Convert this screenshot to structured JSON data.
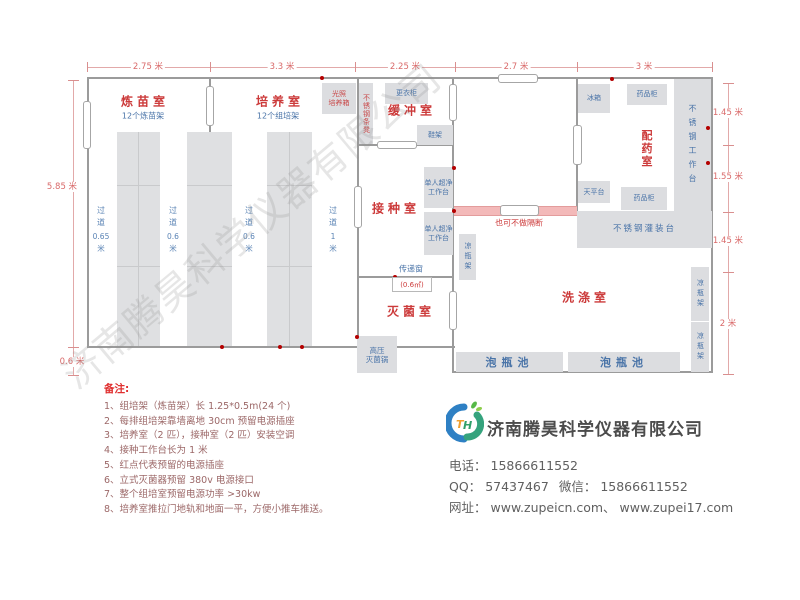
{
  "dims": {
    "top": [
      "2.75 米",
      "3.3 米",
      "2.25 米",
      "2.7 米",
      "3 米"
    ],
    "left_main": "5.85 米",
    "left_ext": "0.6 米",
    "right": [
      "1.45 米",
      "1.55 米",
      "1.45 米",
      "2 米"
    ]
  },
  "rooms": {
    "lianmiao": "炼苗室",
    "lianmiao_sub": "12个炼苗架",
    "peiyang": "培养室",
    "peiyang_sub": "12个组培架",
    "huanchong": "缓冲室",
    "jiezhong": "接种室",
    "miejun": "灭菌室",
    "xidi": "洗涤室",
    "peiyao": "配药室"
  },
  "furniture": {
    "light_incubator_1": "光照",
    "light_incubator_2": "培养箱",
    "steel_bench": "不锈钢条凳",
    "wardrobe": "更衣柜",
    "shoe_rack": "鞋架",
    "clean_bench_1": "单人超净",
    "clean_bench_2": "工作台",
    "cool_rack": "凉瓶架",
    "autoclave_1": "高压",
    "autoclave_2": "灭菌锅",
    "fridge": "冰箱",
    "med_cabinet_top": "药品柜",
    "med_cabinet_bottom": "药品柜",
    "steel_worktable": "不锈钢工作台",
    "balance_table": "天平台",
    "filling_table": "不锈钢灌装台",
    "soak_pool_1": "泡瓶池",
    "soak_pool_2": "泡瓶池",
    "cool_rack_r1": "凉瓶架",
    "cool_rack_r2": "凉瓶架"
  },
  "aisles": [
    {
      "name": "过道",
      "value": "0.65",
      "unit": "米"
    },
    {
      "name": "过道",
      "value": "0.6",
      "unit": "米"
    },
    {
      "name": "过道",
      "value": "0.6",
      "unit": "米"
    },
    {
      "name": "过道",
      "value": "1",
      "unit": "米"
    }
  ],
  "annotations": {
    "partition": "也可不做隔断",
    "transfer_window": "传递窗",
    "transfer_area": "(0.6㎡)"
  },
  "notes": {
    "header": "备注:",
    "items": [
      "1、组培架（炼苗架）长 1.25*0.5m(24 个)",
      "2、每排组培架靠墙离地 30cm 预留电源插座",
      "3、培养室（2 匹），接种室（2 匹）安装空调",
      "4、接种工作台长为 1 米",
      "5、红点代表预留的电源插座",
      "6、立式灭菌器预留 380v 电源接口",
      "7、整个组培室预留电源功率 >30kw",
      "8、培养室推拉门地轨和地面一平，方便小推车推送。"
    ]
  },
  "company": {
    "name": "济南腾昊科学仪器有限公司",
    "phone_label": "电话：",
    "phone": "15866611552",
    "qq_label": "QQ：",
    "qq": "57437467",
    "wechat_label": "微信：",
    "wechat": "15866611552",
    "web_label": "网址：",
    "websites": "www.zupeicn.com、 www.zupei17.com",
    "logo_t": "T",
    "logo_h": "H"
  },
  "watermark": "济南腾昊科学仪器有限公司",
  "colors": {
    "room_label_red": "#cc3a3a",
    "furniture_blue": "#4a74a8",
    "dimension_red": "#d96a6a",
    "wall_gray": "#9b9b9b",
    "box_gray": "#dcdde0",
    "partition_pink": "#f3b9b9",
    "socket_red": "#b40000"
  }
}
